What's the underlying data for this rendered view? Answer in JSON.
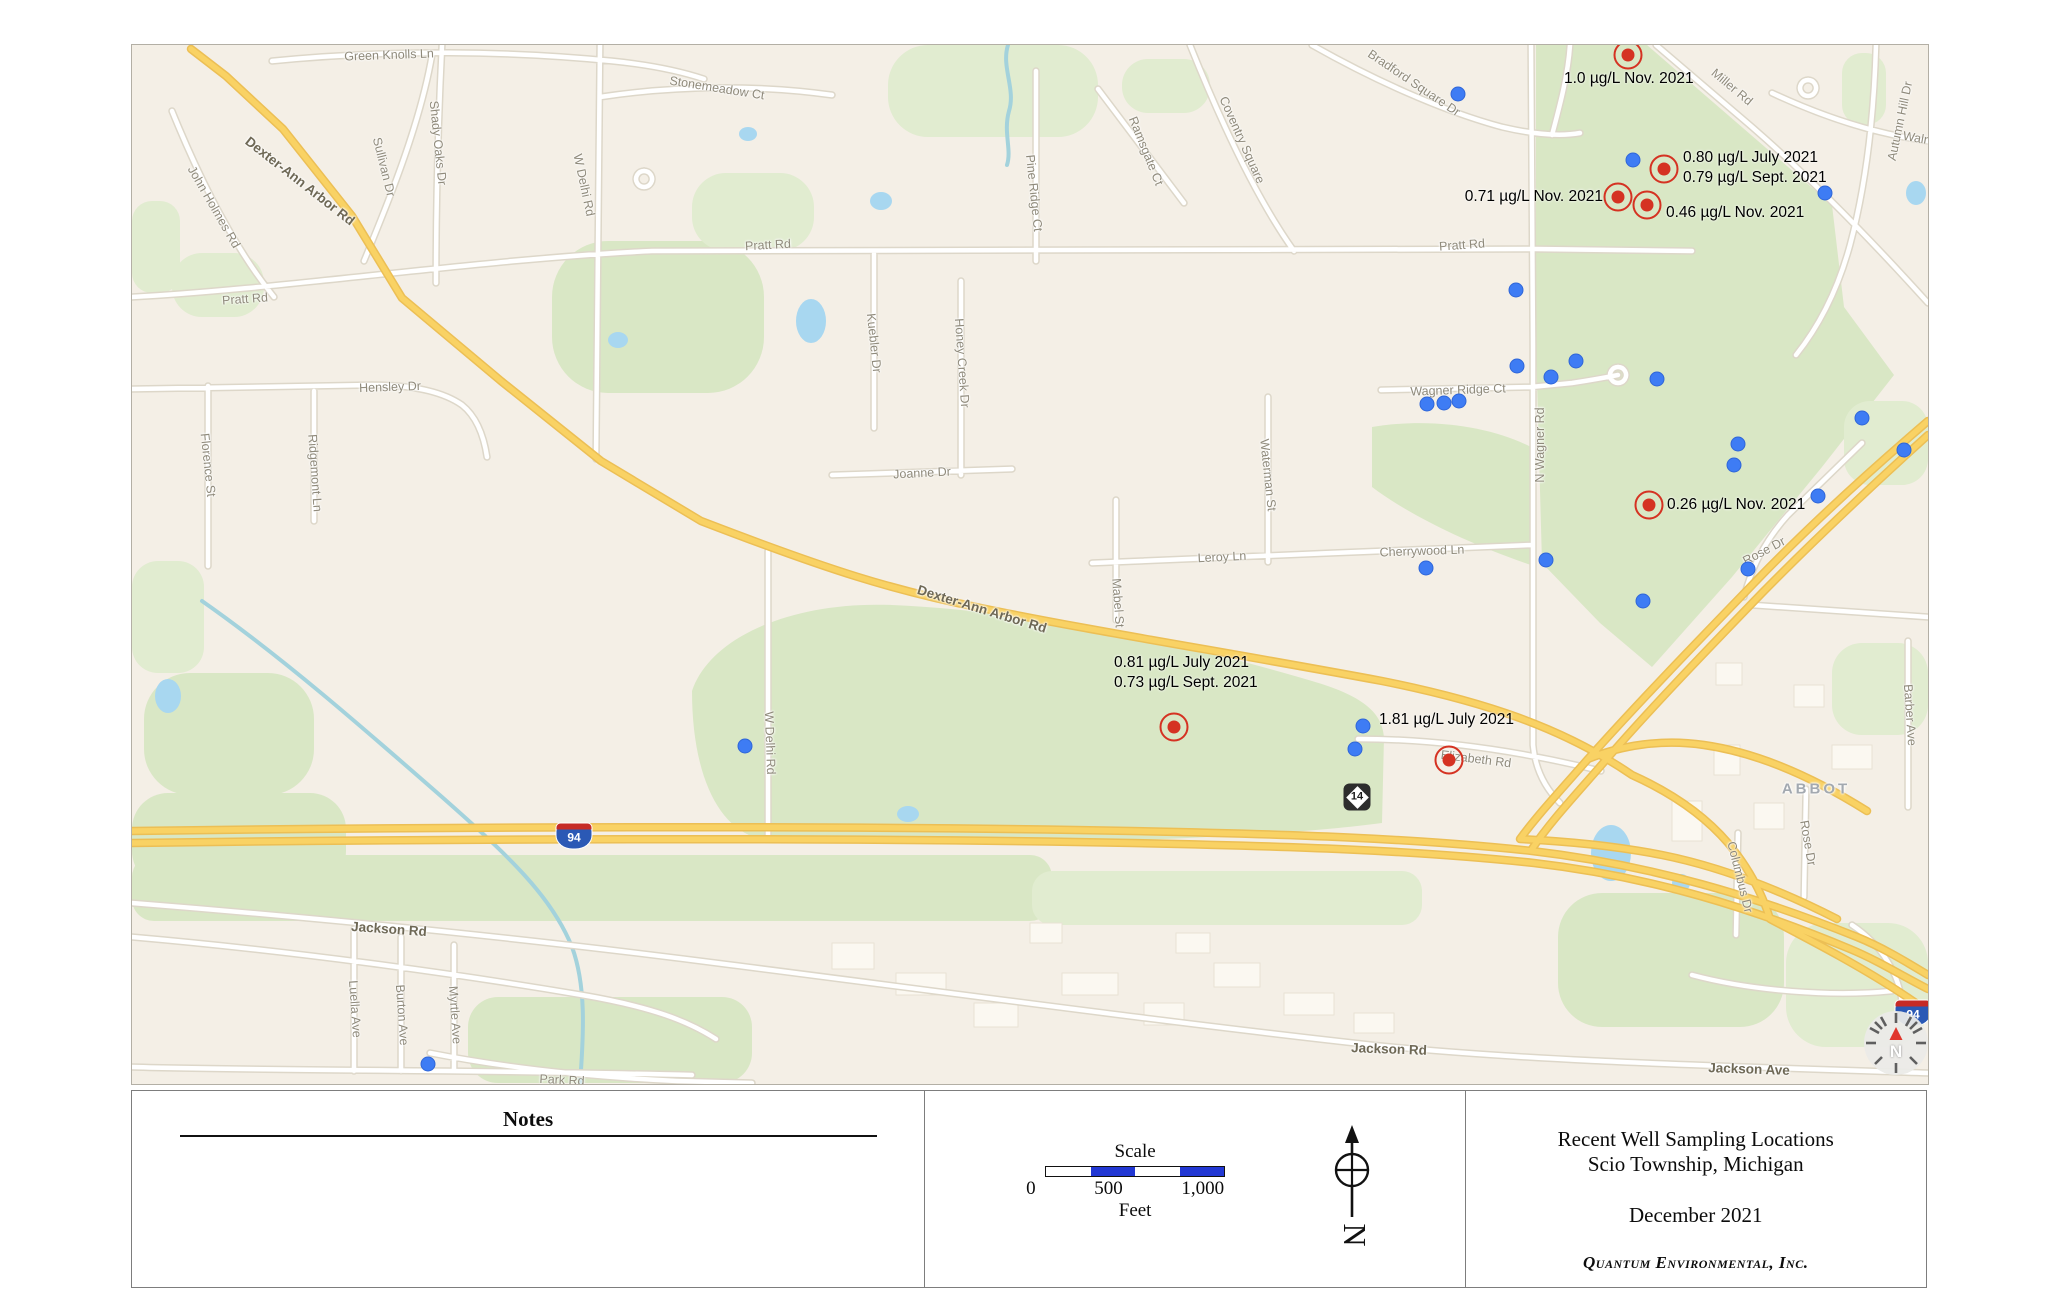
{
  "map": {
    "colors": {
      "sample_red": "#d53222",
      "well_blue": "#3e7cf4",
      "green_area": "#d9e7c5",
      "highway_yellow": "#f9d264",
      "water_blue": "#a8d7f0"
    },
    "shields": {
      "interstate": "94",
      "route": "14",
      "compass": "N"
    },
    "road_labels": [
      {
        "t": "Green Knolls Ln",
        "x": 257,
        "y": 10,
        "r": -2
      },
      {
        "t": "Stonemeadow Ct",
        "x": 585,
        "y": 43,
        "r": 9
      },
      {
        "t": "Shady Oaks Dr",
        "x": 306,
        "y": 98,
        "r": 84
      },
      {
        "t": "Sullivan Dr",
        "x": 252,
        "y": 122,
        "r": 76
      },
      {
        "t": "Dexter-Ann Arbor Rd",
        "x": 168,
        "y": 136,
        "r": 38,
        "c": "bold"
      },
      {
        "t": "John Holmes Rd",
        "x": 82,
        "y": 162,
        "r": 60
      },
      {
        "t": "W Delhi Rd",
        "x": 452,
        "y": 140,
        "r": 78
      },
      {
        "t": "Pine Ridge Ct",
        "x": 902,
        "y": 148,
        "r": 84
      },
      {
        "t": "Ramsgate Ct",
        "x": 1014,
        "y": 106,
        "r": 68
      },
      {
        "t": "Coventry Square",
        "x": 1110,
        "y": 95,
        "r": 66
      },
      {
        "t": "Bradford Square Dr",
        "x": 1282,
        "y": 38,
        "r": 34
      },
      {
        "t": "Miller Rd",
        "x": 1600,
        "y": 42,
        "r": 40
      },
      {
        "t": "Autumn Hill Dr",
        "x": 1768,
        "y": 76,
        "r": -78
      },
      {
        "t": "Walnut",
        "x": 1790,
        "y": 94,
        "r": 10
      },
      {
        "t": "Pratt Rd",
        "x": 113,
        "y": 254,
        "r": -4
      },
      {
        "t": "Pratt Rd",
        "x": 636,
        "y": 200,
        "r": -3
      },
      {
        "t": "Pratt Rd",
        "x": 1330,
        "y": 200,
        "r": -4
      },
      {
        "t": "Hensley Dr",
        "x": 258,
        "y": 342,
        "r": -2
      },
      {
        "t": "Florence St",
        "x": 76,
        "y": 420,
        "r": 84
      },
      {
        "t": "Ridgemont Ln",
        "x": 183,
        "y": 428,
        "r": 86
      },
      {
        "t": "Kuebler Dr",
        "x": 742,
        "y": 298,
        "r": 84
      },
      {
        "t": "Honey Creek Dr",
        "x": 830,
        "y": 318,
        "r": 86
      },
      {
        "t": "Joanne Dr",
        "x": 790,
        "y": 428,
        "r": -3
      },
      {
        "t": "Waterman St",
        "x": 1136,
        "y": 430,
        "r": 84
      },
      {
        "t": "Mabel St",
        "x": 986,
        "y": 558,
        "r": 86
      },
      {
        "t": "Leroy Ln",
        "x": 1090,
        "y": 512,
        "r": -3
      },
      {
        "t": "Cherrywood Ln",
        "x": 1290,
        "y": 506,
        "r": -2
      },
      {
        "t": "Wagner Ridge Ct",
        "x": 1326,
        "y": 345,
        "r": -2
      },
      {
        "t": "N Wagner Rd",
        "x": 1408,
        "y": 400,
        "r": -90
      },
      {
        "t": "Rose Dr",
        "x": 1632,
        "y": 506,
        "r": -28
      },
      {
        "t": "Barber Ave",
        "x": 1778,
        "y": 670,
        "r": 86
      },
      {
        "t": "ABBOT",
        "x": 1684,
        "y": 744,
        "r": 0,
        "c": "area"
      },
      {
        "t": "Rose Dr",
        "x": 1676,
        "y": 798,
        "r": 80
      },
      {
        "t": "Columbus Dr",
        "x": 1608,
        "y": 832,
        "r": 76
      },
      {
        "t": "Dexter-Ann Arbor Rd",
        "x": 850,
        "y": 564,
        "r": 17,
        "c": "bold"
      },
      {
        "t": "W Delhi Rd",
        "x": 638,
        "y": 698,
        "r": 88
      },
      {
        "t": "Elizabeth Rd",
        "x": 1344,
        "y": 714,
        "r": 7
      },
      {
        "t": "Jackson Rd",
        "x": 257,
        "y": 884,
        "r": 4,
        "c": "bold"
      },
      {
        "t": "Jackson Rd",
        "x": 1257,
        "y": 1004,
        "r": 2,
        "c": "bold"
      },
      {
        "t": "Jackson Ave",
        "x": 1617,
        "y": 1024,
        "r": 2,
        "c": "bold"
      },
      {
        "t": "Park Rd",
        "x": 430,
        "y": 1035,
        "r": 3
      },
      {
        "t": "Luella Ave",
        "x": 223,
        "y": 964,
        "r": 86
      },
      {
        "t": "Burton Ave",
        "x": 270,
        "y": 970,
        "r": 86
      },
      {
        "t": "Myrtle Ave",
        "x": 323,
        "y": 970,
        "r": 86
      }
    ],
    "well_dots": [
      {
        "x": 1326,
        "y": 49
      },
      {
        "x": 1501,
        "y": 115
      },
      {
        "x": 1693,
        "y": 148
      },
      {
        "x": 1384,
        "y": 245
      },
      {
        "x": 1385,
        "y": 321
      },
      {
        "x": 1419,
        "y": 332
      },
      {
        "x": 1444,
        "y": 316
      },
      {
        "x": 1525,
        "y": 334
      },
      {
        "x": 1295,
        "y": 359
      },
      {
        "x": 1312,
        "y": 358
      },
      {
        "x": 1327,
        "y": 356
      },
      {
        "x": 1606,
        "y": 399
      },
      {
        "x": 1730,
        "y": 373
      },
      {
        "x": 1772,
        "y": 405
      },
      {
        "x": 1602,
        "y": 420
      },
      {
        "x": 1686,
        "y": 451
      },
      {
        "x": 1616,
        "y": 524
      },
      {
        "x": 1511,
        "y": 556
      },
      {
        "x": 1414,
        "y": 515
      },
      {
        "x": 1294,
        "y": 523
      },
      {
        "x": 613,
        "y": 701
      },
      {
        "x": 1231,
        "y": 681
      },
      {
        "x": 1223,
        "y": 704
      },
      {
        "x": 296,
        "y": 1019
      }
    ],
    "sample_markers": [
      {
        "cx": 1496,
        "cy": 10,
        "lx": 1432,
        "ly": 24,
        "align": "left",
        "lines": [
          "1.0 µg/L Nov. 2021"
        ]
      },
      {
        "cx": 1532,
        "cy": 124,
        "lx": 1551,
        "ly": 103,
        "align": "left",
        "lines": [
          "0.80 µg/L July 2021",
          "0.79 µg/L Sept. 2021"
        ]
      },
      {
        "cx": 1486,
        "cy": 152,
        "lx": 1471,
        "ly": 142,
        "align": "right",
        "lines": [
          "0.71 µg/L Nov. 2021"
        ]
      },
      {
        "cx": 1515,
        "cy": 160,
        "lx": 1534,
        "ly": 158,
        "align": "left",
        "lines": [
          "0.46 µg/L Nov. 2021"
        ]
      },
      {
        "cx": 1517,
        "cy": 460,
        "lx": 1535,
        "ly": 450,
        "align": "left",
        "lines": [
          "0.26 µg/L Nov. 2021"
        ]
      },
      {
        "cx": 1042,
        "cy": 682,
        "lx": 982,
        "ly": 608,
        "align": "left",
        "lines": [
          "0.81 µg/L July 2021",
          "0.73 µg/L Sept. 2021"
        ]
      },
      {
        "cx": 1317,
        "cy": 715,
        "lx": 1247,
        "ly": 665,
        "align": "left",
        "lines": [
          "1.81 µg/L July 2021"
        ]
      }
    ]
  },
  "notes": {
    "heading": "Notes",
    "items": [
      "1. Concentrations of 1,4-dioxane shown in micrograms per liter (µg/L).",
      "2. Well water concentrations above the detection limit shown above in large red circles.",
      "3. Well water from all other locations (blue dots) had no detectable concentrations",
      "    of 1,4-dioxane.  The detection limit for all samples was 0.12 µg/L."
    ]
  },
  "scale": {
    "title": "Scale",
    "ticks": [
      "0",
      "500",
      "1,000"
    ],
    "unit": "Feet"
  },
  "north": {
    "label": "N"
  },
  "title_block": {
    "line1": "Recent Well Sampling Locations",
    "line2": "Scio Township, Michigan",
    "date": "December 2021",
    "company": "Quantum Environmental, Inc."
  }
}
